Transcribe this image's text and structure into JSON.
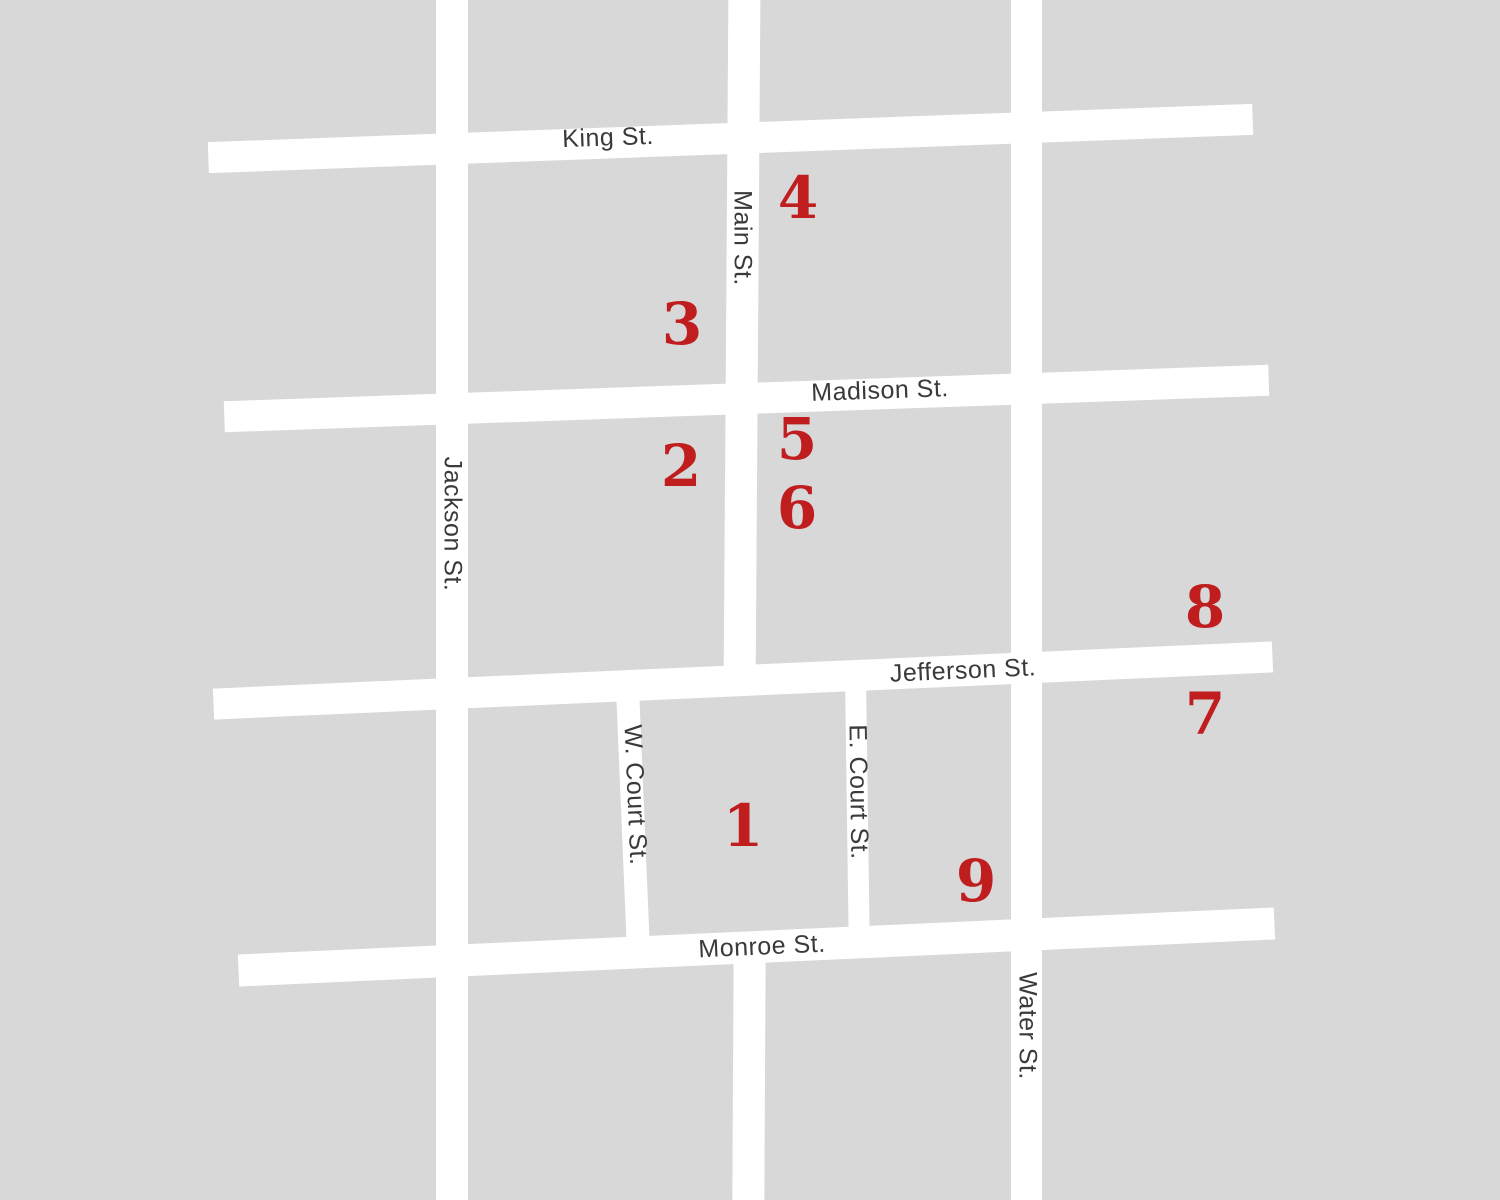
{
  "map": {
    "streets": {
      "king": "King St.",
      "main": "Main St.",
      "madison": "Madison St.",
      "jackson": "Jackson St.",
      "jefferson": "Jefferson St.",
      "w_court": "W. Court St.",
      "e_court": "E. Court St.",
      "monroe": "Monroe St.",
      "water": "Water St."
    },
    "markers": [
      "1",
      "2",
      "3",
      "4",
      "5",
      "6",
      "7",
      "8",
      "9"
    ],
    "colors": {
      "background": "#d8d8d8",
      "street": "#ffffff",
      "street_label": "#3a3a3a",
      "marker": "#c01d1f"
    }
  }
}
